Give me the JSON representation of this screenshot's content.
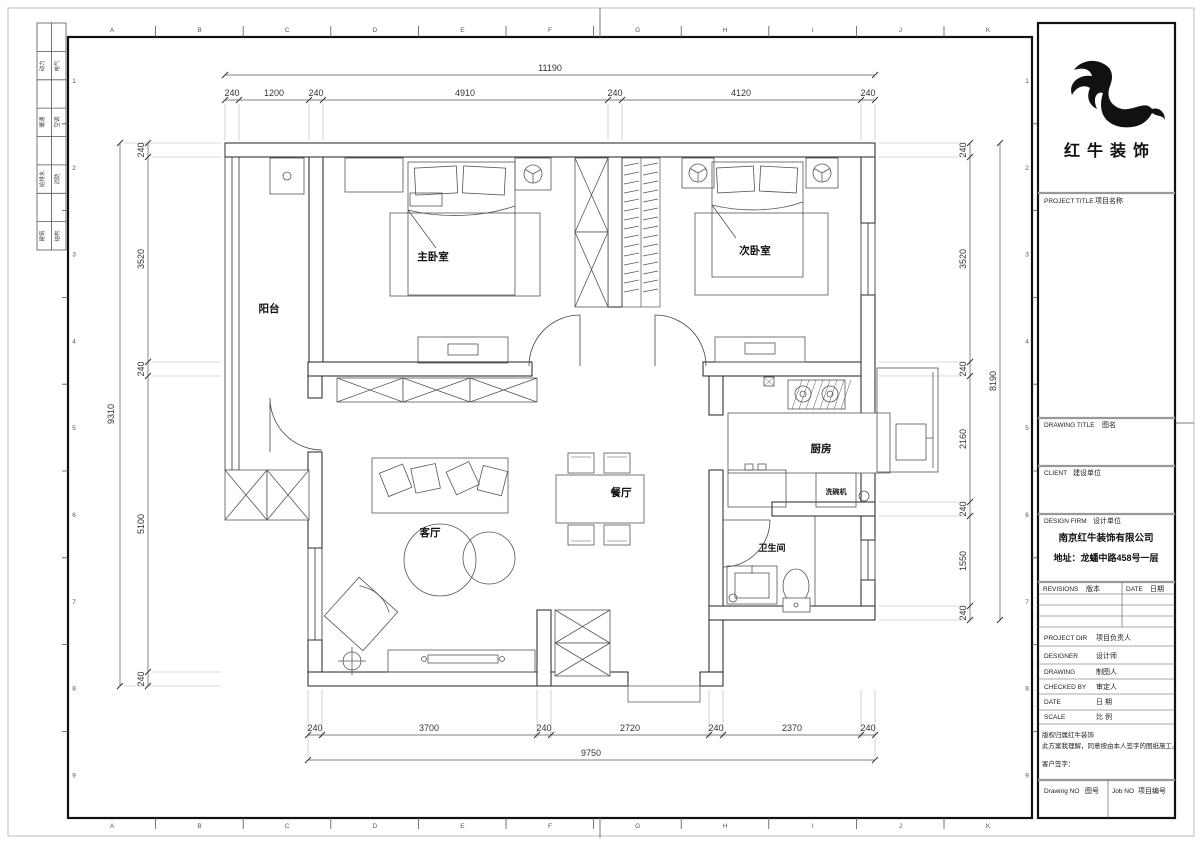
{
  "sheet": {
    "grid_letters": [
      "A",
      "B",
      "C",
      "D",
      "E",
      "F",
      "G",
      "H",
      "I",
      "J",
      "K"
    ],
    "grid_numbers": [
      "1",
      "2",
      "3",
      "4",
      "5",
      "6",
      "7",
      "8",
      "9"
    ],
    "signoff": [
      [
        "动力",
        "电气"
      ],
      [
        "暖通",
        "空调"
      ],
      [
        "给排水",
        "消防"
      ],
      [
        "建筑",
        "结构"
      ]
    ]
  },
  "plan": {
    "labels": {
      "balcony": "阳台",
      "master_bedroom": "主卧室",
      "second_bedroom": "次卧室",
      "living_room": "客厅",
      "dining_room": "餐厅",
      "kitchen": "厨房",
      "bathroom": "卫生间",
      "dishwasher": "洗碗机"
    }
  },
  "dims": {
    "top": {
      "total": "11190",
      "segs": [
        "240",
        "1200",
        "240",
        "4910",
        "240",
        "4120",
        "240"
      ]
    },
    "bottom": {
      "total": "9750",
      "segs": [
        "240",
        "3700",
        "240",
        "2720",
        "240",
        "2370",
        "240"
      ]
    },
    "left": {
      "total": "9310",
      "segs": [
        "240",
        "3520",
        "240",
        "5100",
        "240"
      ]
    },
    "right": {
      "total": "8190",
      "segs": [
        "240",
        "3520",
        "240",
        "2160",
        "240",
        "1550",
        "240"
      ]
    }
  },
  "title_block": {
    "brand": "红牛装饰",
    "project_label": "PROJECT TITLE",
    "project_cn": "项目名称",
    "drawing_label": "DRAWING TITLE",
    "drawing_cn": "图名",
    "client_label": "CLIENT",
    "client_cn": "建设单位",
    "firm_label": "DESIGN FIRM",
    "firm_cn": "设计单位",
    "firm_name": "南京红牛装饰有限公司",
    "firm_address": "地址：龙蟠中路458号一层",
    "revisions_label": "REVISIONS",
    "revisions_cn": "版本",
    "date_label": "DATE",
    "date_cn": "日期",
    "rows": [
      {
        "en": "PROJECT DIR",
        "cn": "项目负责人"
      },
      {
        "en": "DESIGNER",
        "cn": "设计师"
      },
      {
        "en": "DRAWING",
        "cn": "制图人"
      },
      {
        "en": "CHECKED BY",
        "cn": "审定人"
      },
      {
        "en": "DATE",
        "cn": "日 期"
      },
      {
        "en": "SCALE",
        "cn": "比 例"
      }
    ],
    "copyright": "版权归属红牛装饰",
    "statement": "此方案我理解，同意按由本人签字的图纸施工。",
    "signature": "客户签字：",
    "drawing_no_label": "Drawing NO",
    "drawing_no_cn": "图号",
    "job_no_label": "Job NO",
    "job_no_cn": "项目编号"
  }
}
